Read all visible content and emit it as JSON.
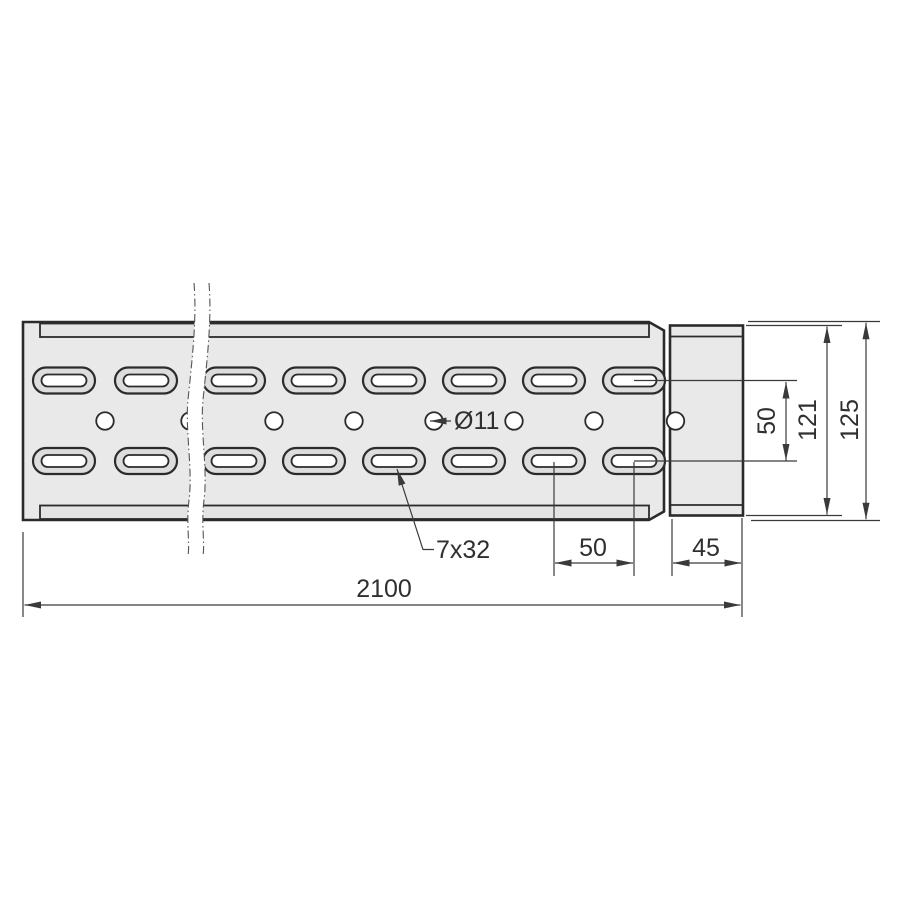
{
  "colors": {
    "background": "#ffffff",
    "outline": "#2b2b2b",
    "dim": "#3a3a3a",
    "text": "#2f2f2f",
    "body_fill": "#e9e9e9",
    "band_fill": "#e4e4e4",
    "ring_fill": "#dddddd",
    "hole_fill": "#ffffff"
  },
  "dimensions": {
    "total_length": "2100",
    "slot_pitch": "50",
    "end_section_width": "45",
    "slot_rows_distance": "50",
    "inner_height": "121",
    "outer_height": "125",
    "hole_diameter": "Ø11",
    "slot_size": "7x32"
  },
  "geometry": {
    "slot_columns_x": [
      64,
      146,
      234,
      314,
      394,
      474,
      554,
      634
    ],
    "slot_row_top_y": 380.5,
    "slot_row_bottom_y": 461,
    "slot_outer": {
      "w": 62,
      "h": 26,
      "r": 13
    },
    "slot_inner": {
      "w": 45,
      "h": 12,
      "r": 6
    },
    "hole_centers_x": [
      105,
      190,
      274,
      354,
      434,
      514,
      594,
      675.5
    ],
    "hole_center_y": 421,
    "hole_radius": 8.75
  }
}
